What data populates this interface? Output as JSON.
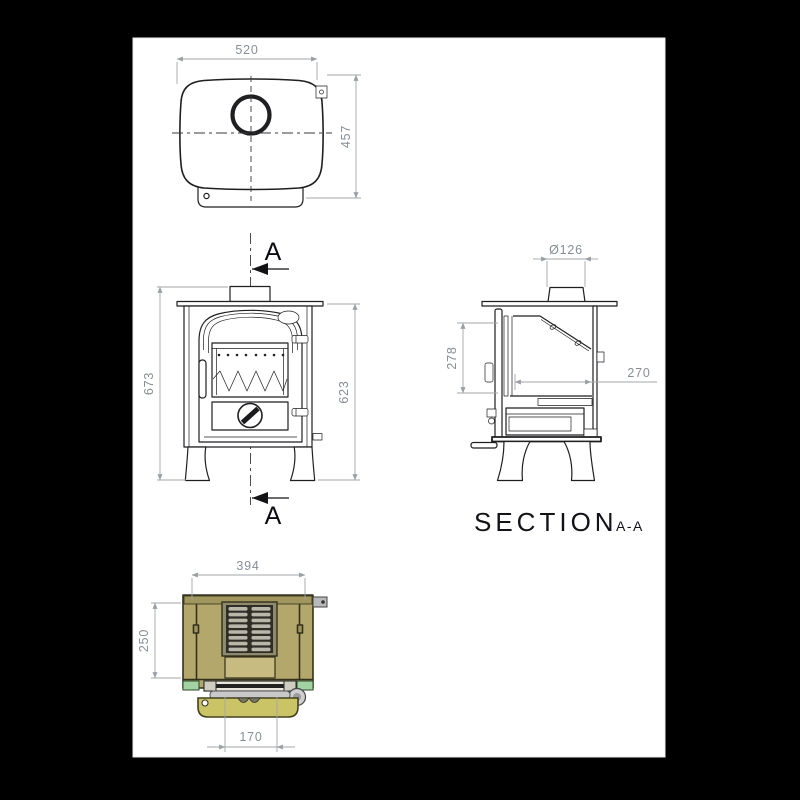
{
  "drawing": {
    "section_label": {
      "title": "SECTION",
      "suffix": "A-A"
    },
    "cut_marker": {
      "top": "A",
      "bottom": "A"
    },
    "top_view": {
      "width": "520",
      "depth": "457"
    },
    "front_view": {
      "overall_height": "673",
      "body_height": "623"
    },
    "section_view": {
      "flue_diameter": "Ø126",
      "firebox_height": "278",
      "firebox_depth": "270"
    },
    "bottom_view": {
      "width": "394",
      "depth": "250",
      "ash_lip_width": "170"
    },
    "colors": {
      "canvas": "#000000",
      "sheet": "#ffffff",
      "outline": "#1f1f22",
      "dimension": "#a0a5aa",
      "dimension_text": "#878e96",
      "body_khaki": "#b4a76c",
      "band_khaki": "#a1965d",
      "panel_light": "#c7bb81",
      "grate_frame": "#8f8a6e",
      "grate_dark": "#2e2d26",
      "grate_slat": "#b9b7aa",
      "pad_green": "#a3d3a3",
      "door_yellow": "#cbc466",
      "metal_gray": "#c9c9c9"
    }
  }
}
